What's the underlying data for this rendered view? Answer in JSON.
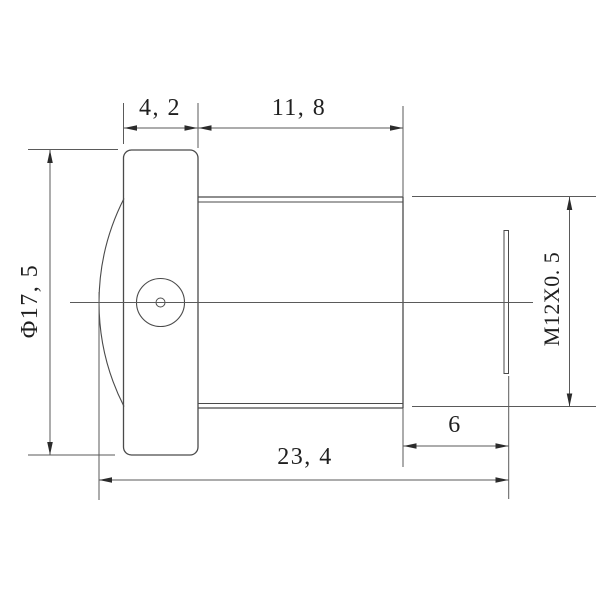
{
  "drawing": {
    "kind": "lens-mechanical-dimension-drawing",
    "dimensions": {
      "cap_width_label": "4, 2",
      "barrel_length_label": "11, 8",
      "diameter_label": "Φ17, 5",
      "thread_label": "M12X0. 5",
      "rear_length_label": "6",
      "total_length_label": "23, 4"
    },
    "colors": {
      "object_line": "#4a4a4a",
      "dimension_line": "#5a5a5a",
      "arrow": "#2b2b2b",
      "text": "#1f1f1f",
      "background": "#ffffff"
    }
  }
}
